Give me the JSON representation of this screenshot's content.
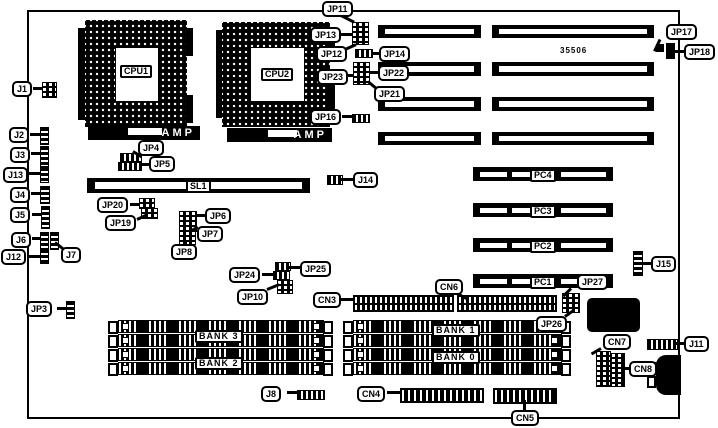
{
  "diagram": {
    "board_number": "35506",
    "cpu1_label": "CPU1",
    "cpu2_label": "CPU2",
    "amp_label": "AMP",
    "sl1_label": "SL1"
  },
  "slots": {
    "pci": [
      "PC4",
      "PC3",
      "PC2",
      "PC1"
    ],
    "banks": [
      "BANK 3",
      "BANK 2",
      "BANK 1",
      "BANK 0"
    ]
  },
  "callouts": {
    "j1": "J1",
    "j2": "J2",
    "j3": "J3",
    "j4": "J4",
    "j5": "J5",
    "j6": "J6",
    "j7": "J7",
    "j8": "J8",
    "j11": "J11",
    "j12": "J12",
    "j13": "J13",
    "j14": "J14",
    "j15": "J15",
    "jp3": "JP3",
    "jp4": "JP4",
    "jp5": "JP5",
    "jp6": "JP6",
    "jp7": "JP7",
    "jp8": "JP8",
    "jp10": "JP10",
    "jp11": "JP11",
    "jp12": "JP12",
    "jp13": "JP13",
    "jp14": "JP14",
    "jp16": "JP16",
    "jp17": "JP17",
    "jp18": "JP18",
    "jp19": "JP19",
    "jp20": "JP20",
    "jp21": "JP21",
    "jp22": "JP22",
    "jp23": "JP23",
    "jp24": "JP24",
    "jp25": "JP25",
    "jp26": "JP26",
    "jp27": "JP27",
    "cn3": "CN3",
    "cn4": "CN4",
    "cn5": "CN5",
    "cn6": "CN6",
    "cn7": "CN7",
    "cn8": "CN8"
  }
}
